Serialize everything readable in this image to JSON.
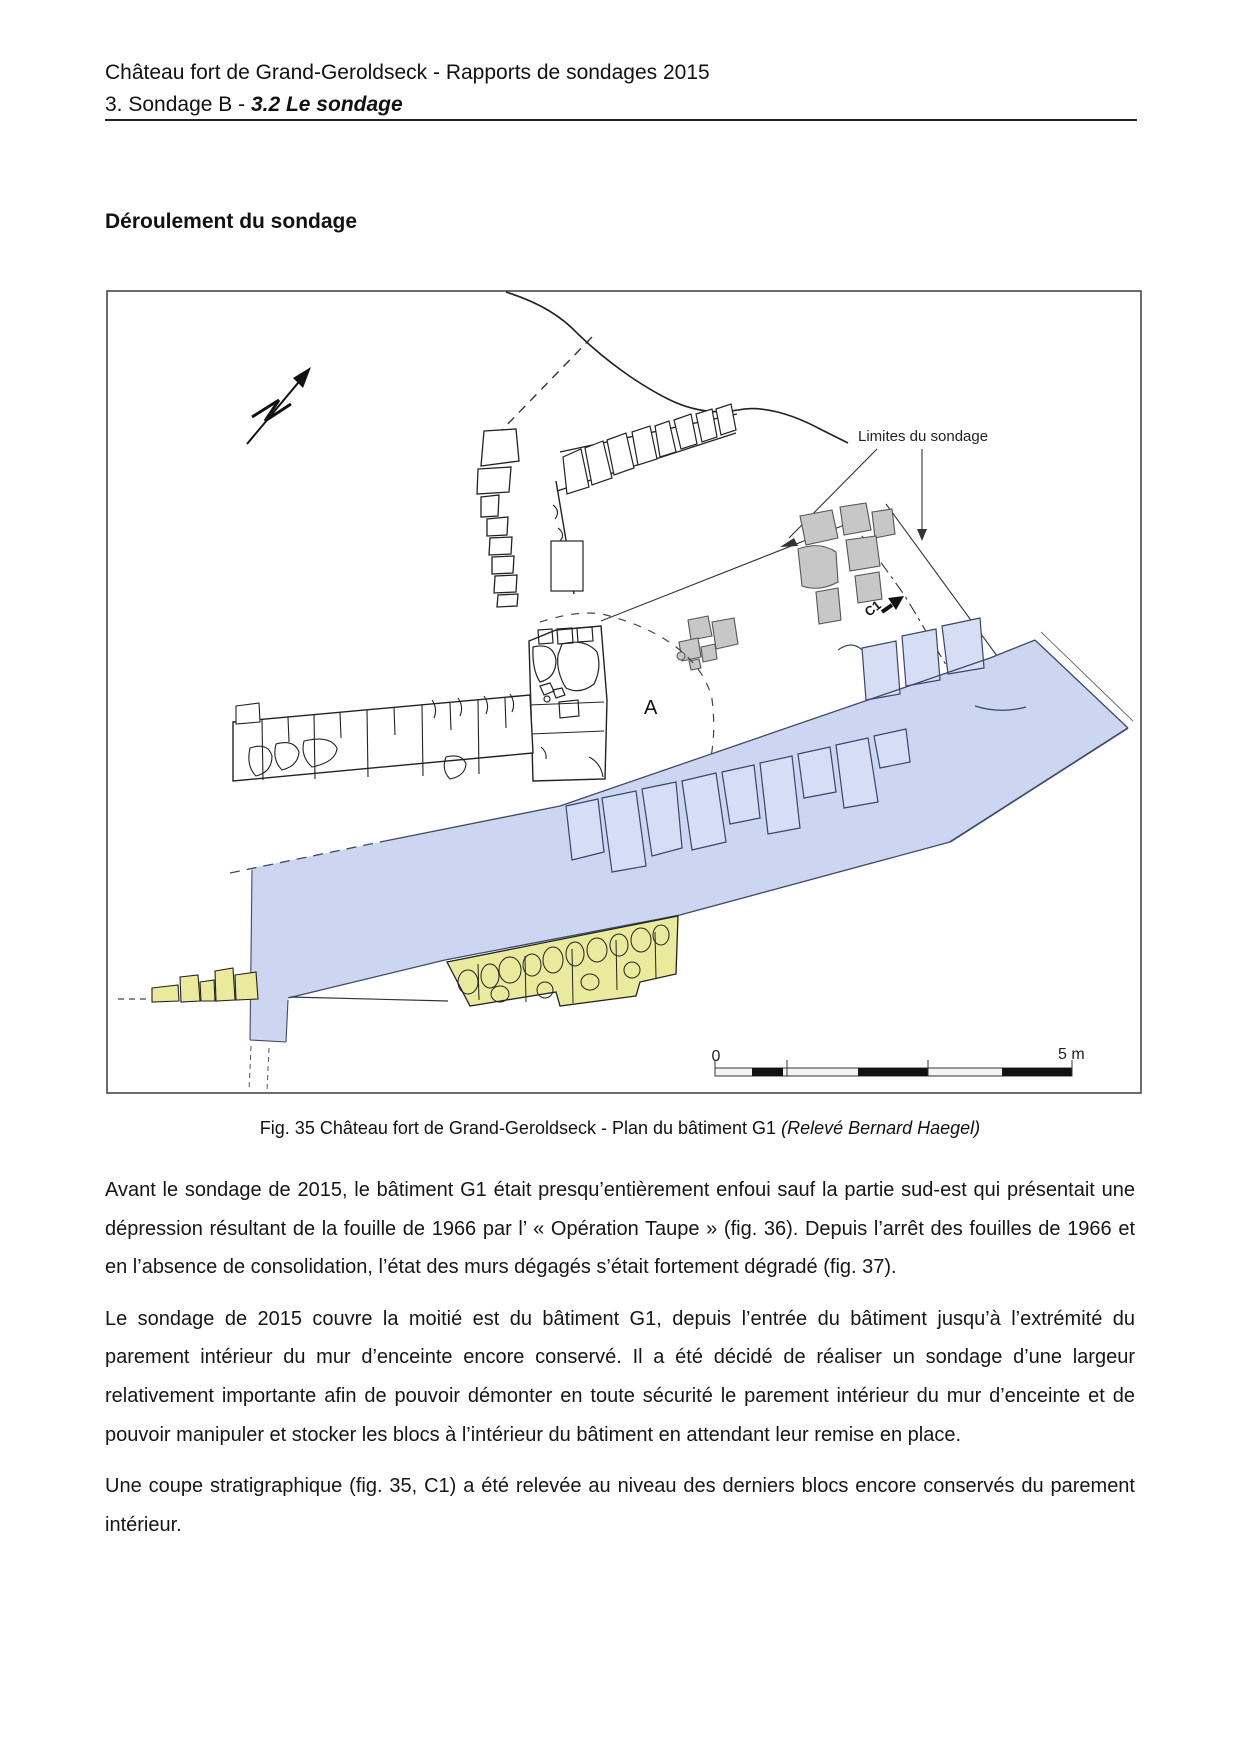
{
  "header": {
    "line1": "Château fort de Grand-Geroldseck - Rapports de sondages 2015",
    "line2_prefix": "3. Sondage B - ",
    "line2_bold": "3.2 Le sondage"
  },
  "heading": {
    "text": "Déroulement du sondage"
  },
  "figure": {
    "labels": {
      "limites": "Limites du sondage",
      "section_marker": "C1",
      "room_a": "A"
    },
    "scale": {
      "zero": "0",
      "five_m": "5 m"
    },
    "colors": {
      "rampart_blue": "#ccd6f0",
      "blue_stone": "#d6def5",
      "stone_yellow": "#eaea9c",
      "stone_gray": "#c7c7c7"
    }
  },
  "caption": {
    "text": "Fig. 35 Château fort de Grand-Geroldseck - Plan du bâtiment G1 ",
    "credit": "(Relevé Bernard Haegel)"
  },
  "paragraphs": [
    "Avant le sondage de 2015, le bâtiment G1 était presqu’entièrement enfoui sauf la partie sud-est qui présentait une dépression résultant de la fouille de 1966 par l’ « Opération Taupe » (fig. 36). Depuis l’arrêt des fouilles de 1966 et en l’absence de consolidation, l’état des murs dégagés s’était fortement dégradé (fig. 37).",
    "Le sondage de 2015 couvre la moitié est du bâtiment G1, depuis l’entrée du bâtiment jusqu’à l’extrémité du parement intérieur du mur d’enceinte encore conservé. Il a été décidé de réaliser un sondage d’une largeur relativement importante afin de pouvoir démonter en toute sécurité le parement intérieur du mur d’enceinte et de pouvoir manipuler et stocker les blocs à l’intérieur du bâtiment en attendant leur remise en place.",
    "Une coupe stratigraphique (fig. 35, C1) a été relevée au niveau des derniers blocs encore conservés du parement intérieur."
  ]
}
